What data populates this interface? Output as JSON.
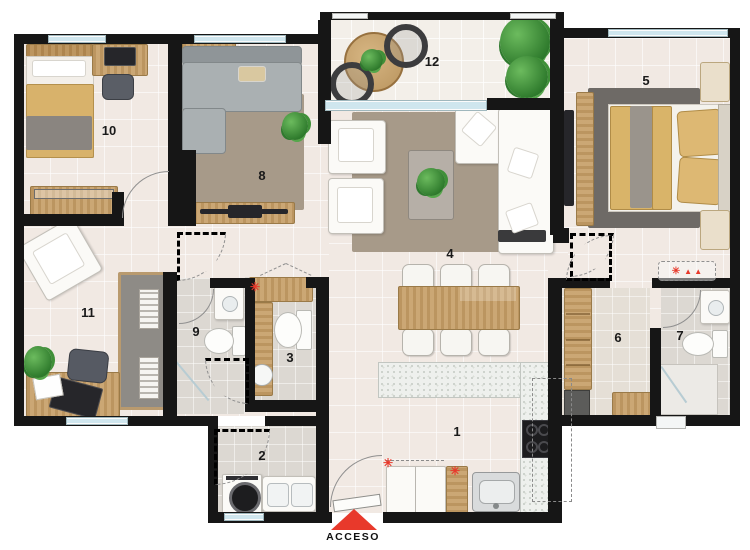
{
  "plan": {
    "room_numbers": [
      "1",
      "2",
      "3",
      "4",
      "5",
      "6",
      "7",
      "8",
      "9",
      "10",
      "11",
      "12"
    ],
    "access_label": "ACCESO",
    "markers": {
      "asterisk": "✳",
      "triangles": "▲ ▲"
    },
    "colors": {
      "wall": "#161616",
      "accent_red": "#e8392b",
      "floor": "#f1e9e3",
      "wet_floor": "#dcd8d2",
      "window_glass": "#cfe6ee",
      "wood": "#c8a26c",
      "rug_brown": "#a79a89",
      "rug_dark": "#6e6a66",
      "sofa_gray": "#aab0b2"
    }
  }
}
